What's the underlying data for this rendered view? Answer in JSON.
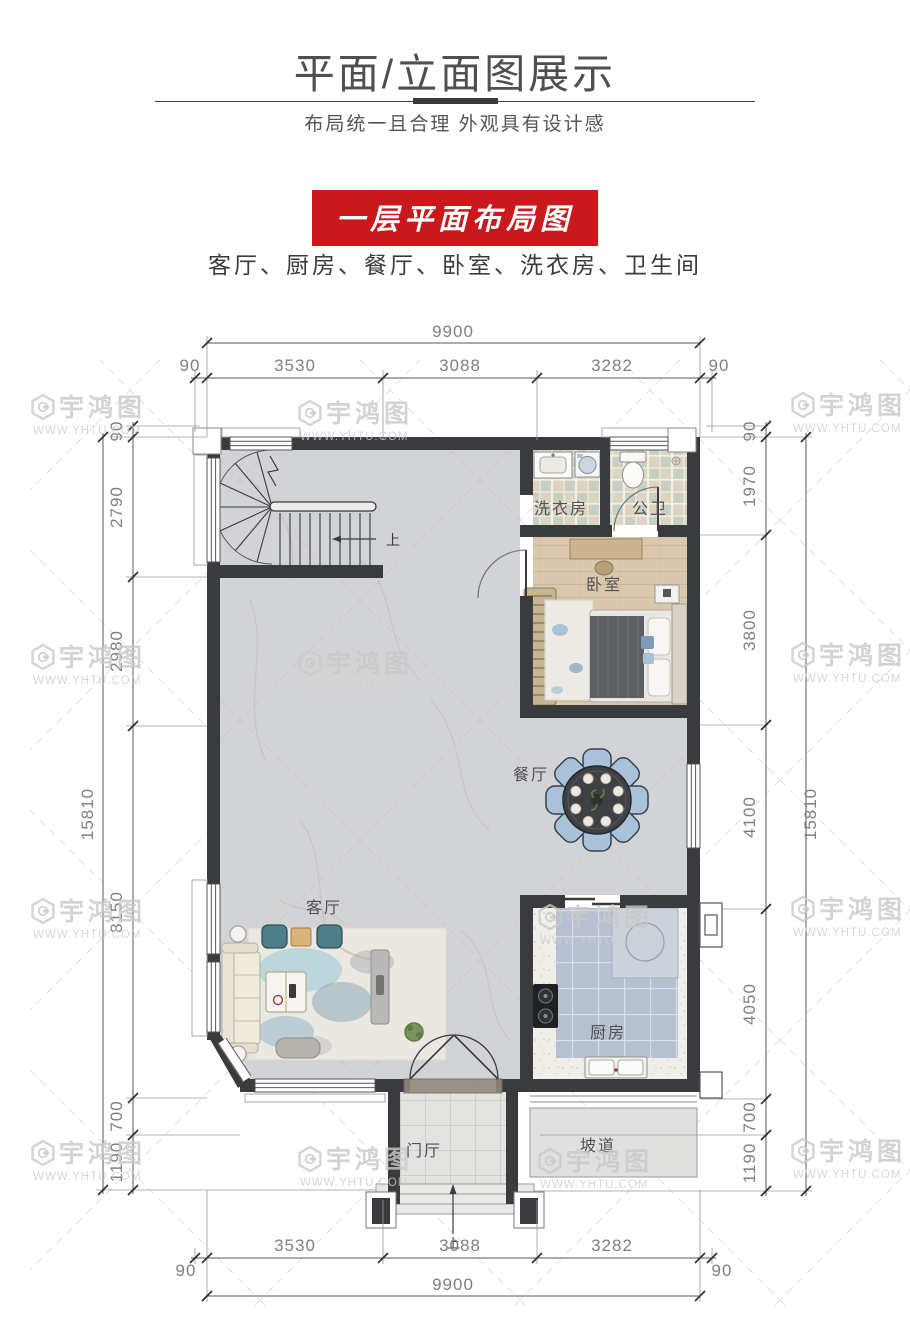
{
  "header": {
    "title": "平面/立面图展示",
    "subtitle": "布局统一且合理 外观具有设计感",
    "banner": "一层平面布局图",
    "room_list": "客厅、厨房、餐厅、卧室、洗衣房、卫生间"
  },
  "watermark": {
    "name": "宇鸿图",
    "url": "WWW.YHTU.COM"
  },
  "plan": {
    "rooms": {
      "laundry": "洗衣房",
      "bath": "公卫",
      "bedroom": "卧室",
      "dining": "餐厅",
      "living": "客厅",
      "kitchen": "厨房",
      "foyer": "门厅",
      "ramp": "坡道"
    },
    "stairs_up": "上",
    "entry_up": "上",
    "dimensions": {
      "top": {
        "overall": "9900",
        "segments": [
          "90",
          "3530",
          "3088",
          "3282",
          "90"
        ]
      },
      "bottom": {
        "overall": "9900",
        "segments": [
          "3530",
          "3088",
          "3282"
        ],
        "left_offset": "90",
        "right_offset": "90"
      },
      "left": {
        "overall": "15810",
        "segments": [
          "90",
          "2790",
          "2980",
          "8150",
          "700",
          "1190"
        ]
      },
      "right": {
        "overall": "15810",
        "segments": [
          "90",
          "1970",
          "3800",
          "4100",
          "4050",
          "700",
          "1190"
        ]
      }
    }
  },
  "colors": {
    "banner_red": "#c9191d",
    "wall": "#3a3b3d",
    "marble_floor": "#d2d3d5",
    "wood_floor": "#d9c7ae",
    "kitchen_tile": "#b6c0d0",
    "dining_chair": "#a9c2d9",
    "watermark_gray": "#c9c9c9"
  }
}
